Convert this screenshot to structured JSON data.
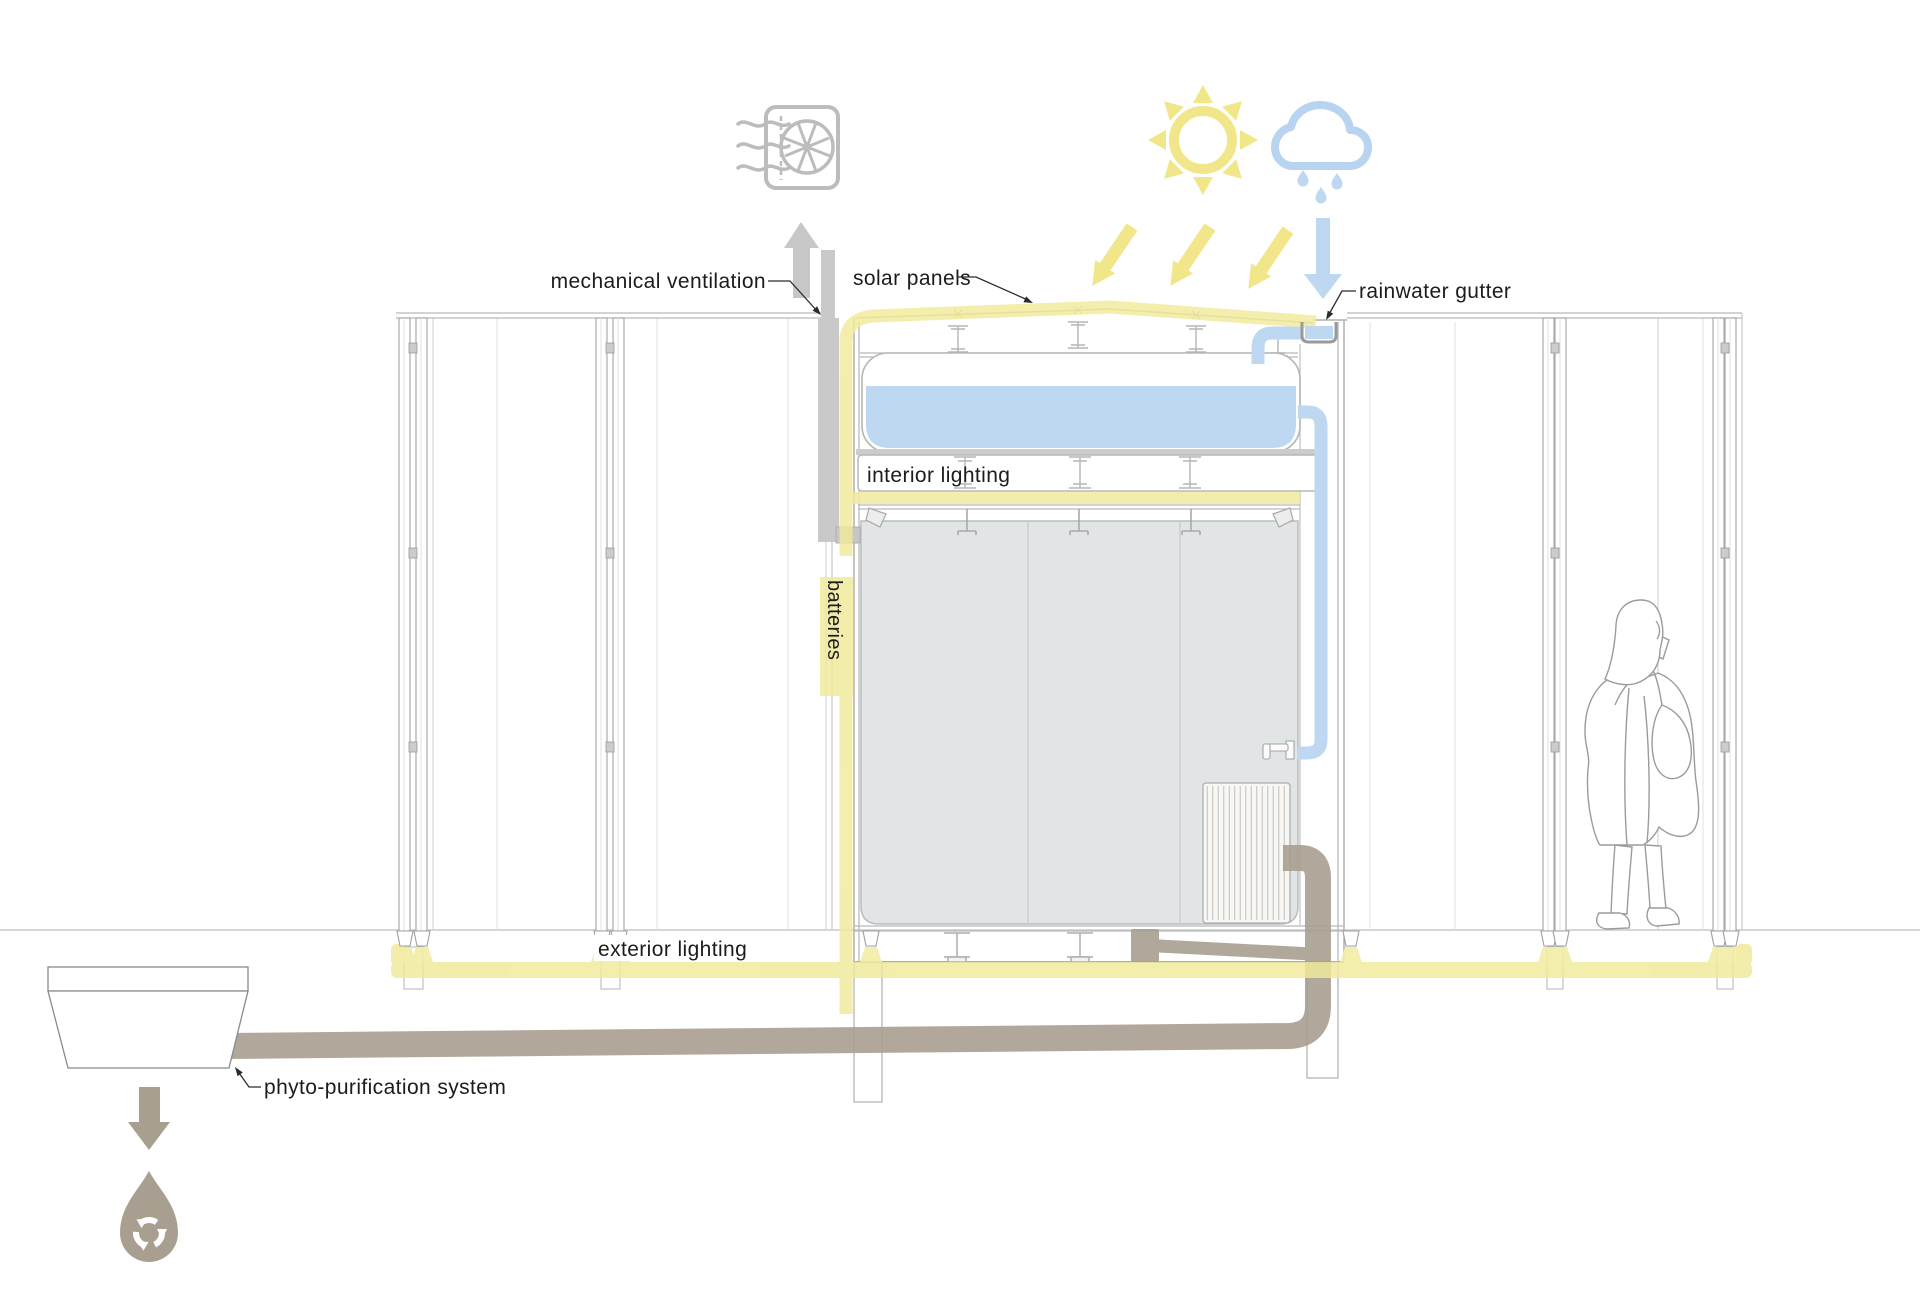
{
  "diagram": {
    "title": "sustainable pavilion section diagram",
    "labels": {
      "mechanical_ventilation": "mechanical ventilation",
      "solar_panels": "solar panels",
      "rainwater_gutter": "rainwater gutter",
      "interior_lighting": "interior lighting",
      "batteries": "batteries",
      "exterior_lighting": "exterior lighting",
      "phyto_purification": "phyto-purification system"
    },
    "icons": [
      "ventilation-fan-icon",
      "up-arrow-icon",
      "sun-icon",
      "rain-cloud-icon",
      "sunlight-arrow-icon",
      "rain-arrow-icon",
      "down-arrow-icon",
      "recycled-water-drop-icon"
    ],
    "colors": {
      "highlight_yellow": "#f1ea9b",
      "sun_yellow": "#f1e78a",
      "water_blue": "#bdd8f0",
      "pipe_taupe": "#a89f90",
      "duct_gray": "#c9c9c9",
      "interior_gray": "#e2e5e5",
      "line_gray": "#b9b9b9",
      "label_black": "#1c1c1c"
    }
  }
}
